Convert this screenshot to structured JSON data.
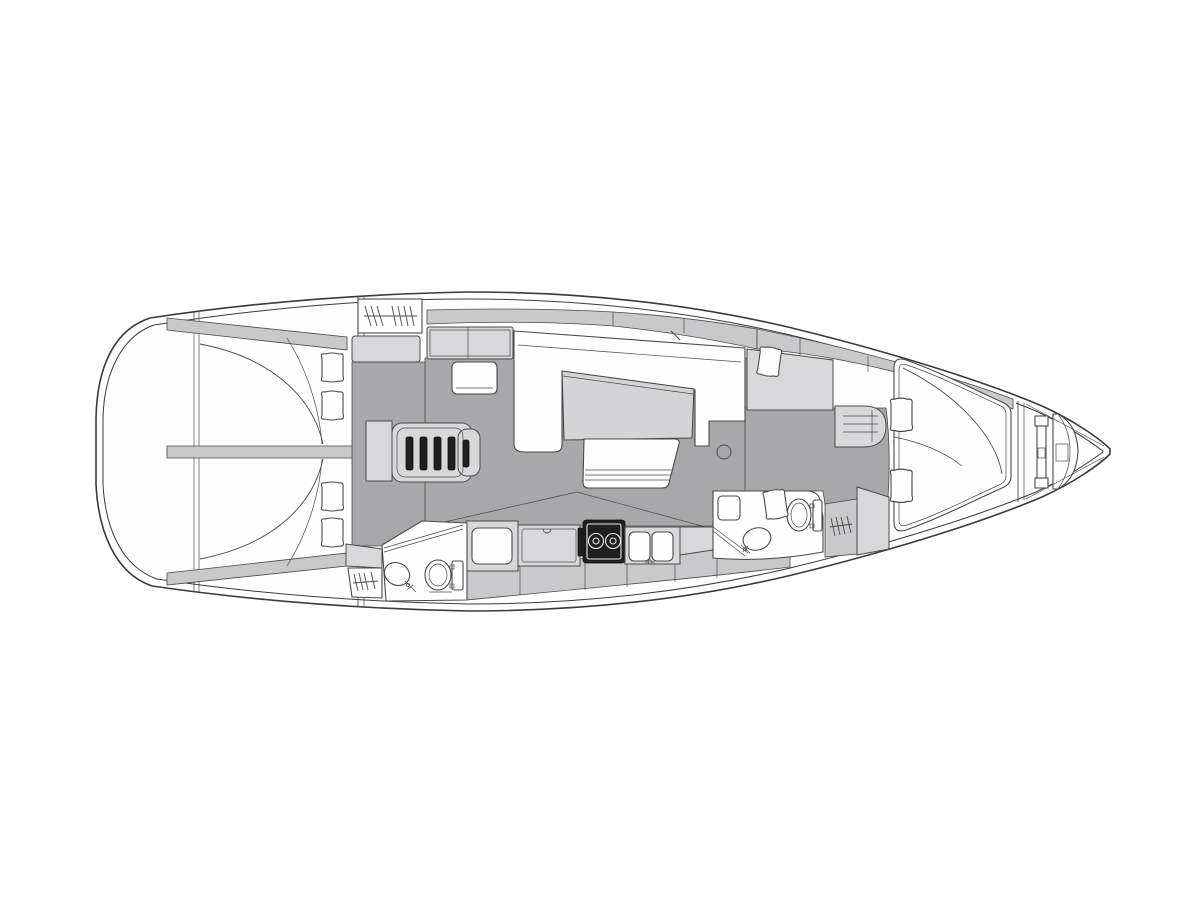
{
  "figure": {
    "type": "technical-drawing",
    "subject": "sailing yacht interior layout plan",
    "view": "top-down deck plan",
    "orientation": {
      "bow": "right",
      "stern": "left"
    }
  },
  "colors": {
    "page_bg": "#ffffff",
    "paper_white": "#fefefe",
    "hull_line": "#3a3a3a",
    "detail_line": "#4a4a4a",
    "floor_gray": "#a8a8aa",
    "furniture_light": "#d8d8da",
    "furniture_mid": "#c9c9cb",
    "table_gray": "#d4d4d6",
    "appliance_dark": "#1f1f1f",
    "appliance_detail": "#e8e8e8"
  },
  "areas": [
    {
      "id": "stern-transom",
      "label": "stern transom and swim platform"
    },
    {
      "id": "aft-cabin-port",
      "label": "aft double cabin, port side, bed with two pillows"
    },
    {
      "id": "aft-cabin-starboard",
      "label": "aft double cabin, starboard side, bed with two pillows"
    },
    {
      "id": "aft-head",
      "label": "aft head: shower partition, wash basin, toilet, hanging locker"
    },
    {
      "id": "companionway",
      "label": "companionway steps, engine box, hanging locker and cabinet"
    },
    {
      "id": "chart-table",
      "label": "chart table with navigator seat"
    },
    {
      "id": "salon",
      "label": "salon: U-shaped settee, dining table, bench seat, mast post"
    },
    {
      "id": "galley",
      "label": "galley: fridge box, locker, two-burner stove, double sink, counters"
    },
    {
      "id": "forward-head",
      "label": "forward head: toilet, wash basin, shower partition, hanging locker"
    },
    {
      "id": "forward-cabin",
      "label": "forward cabin: island double berth, vanity seat, dresser, side shelves"
    },
    {
      "id": "bow-locker",
      "label": "anchor and chain locker with windlass"
    },
    {
      "id": "bow",
      "label": "bow tip"
    }
  ]
}
